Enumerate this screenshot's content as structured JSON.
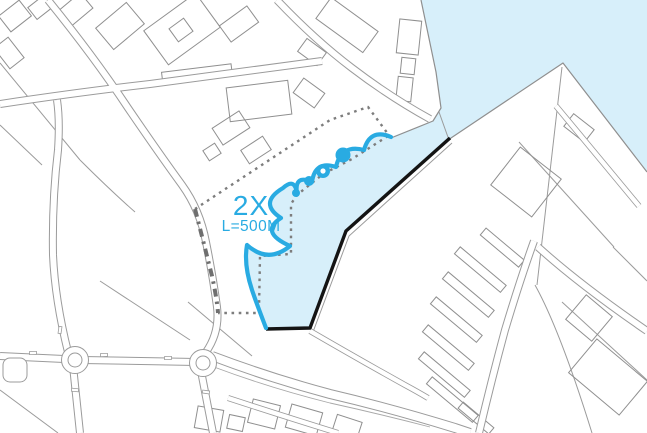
{
  "map": {
    "annotation": {
      "title": "2X",
      "subtitle": "L=500M"
    },
    "colors": {
      "water": "#D7EFFA",
      "accent": "#29ABE2",
      "linework": "#9B9B9B",
      "boundary_dash": "#7D7D7D",
      "street_dashdot": "#6F6F6F",
      "coast_black": "#141414",
      "background": "#FFFFFF"
    }
  }
}
